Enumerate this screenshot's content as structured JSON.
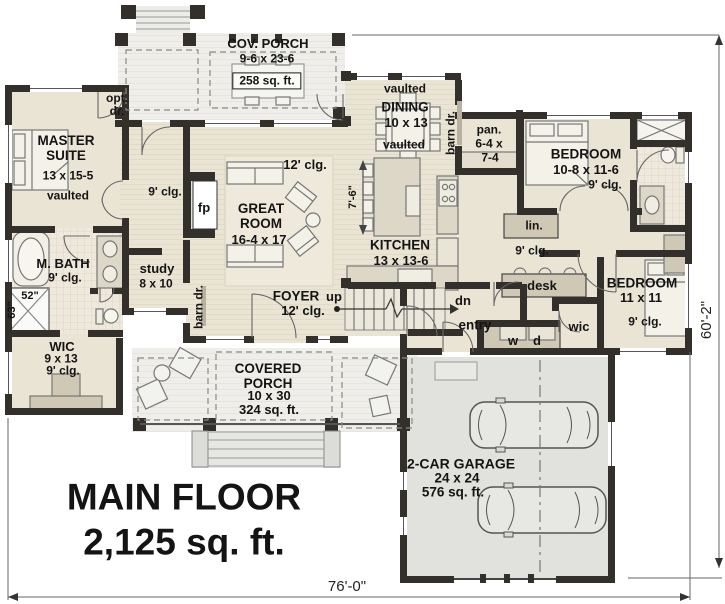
{
  "palette": {
    "wall": "#33302c",
    "floor_beige": "#e9e4d4",
    "porch_gray": "#efeeea",
    "garage_gray": "#e1e1de",
    "cabinet_taupe": "#cfc8b4",
    "text": "#141414"
  },
  "title": {
    "line1": "MAIN FLOOR",
    "line2": "2,125 sq. ft."
  },
  "dimensions": {
    "width": "76'-0\"",
    "height": "60'-2\""
  },
  "rooms": {
    "cov_porch": {
      "name": "COV. PORCH",
      "size": "9-6 x 23-6",
      "area": "258 sq. ft."
    },
    "master_suite": {
      "name": "MASTER SUITE",
      "size": "13 x 15-5",
      "ceiling": "vaulted"
    },
    "master_hall": {
      "ceiling": "9' clg."
    },
    "great_room": {
      "name": "GREAT ROOM",
      "size": "16-4 x 17",
      "ceiling": "12' clg."
    },
    "dining": {
      "name": "DINING",
      "size": "10 x 13",
      "vaulted_upper": "vaulted",
      "vaulted_lower": "vaulted"
    },
    "kitchen": {
      "name": "KITCHEN",
      "size": "13 x 13-6",
      "island_depth": "7'-6\""
    },
    "pantry": {
      "name": "pan.",
      "size_line1": "6-4 x",
      "size_line2": "7-4"
    },
    "study": {
      "name": "study",
      "size": "8 x 10"
    },
    "foyer": {
      "name": "FOYER",
      "ceiling": "12' clg.",
      "stairs": "up"
    },
    "master_bath": {
      "name": "M. BATH",
      "ceiling": "9' clg.",
      "shower_width": "52\"",
      "shower_depth": "63\""
    },
    "master_wic": {
      "name": "WIC",
      "size": "9 x 13",
      "ceiling": "9' clg."
    },
    "bedroom_2": {
      "name": "BEDROOM",
      "size": "10-8 x 11-6",
      "ceiling": "9' clg."
    },
    "bedroom_3": {
      "name": "BEDROOM",
      "size": "11 x 11",
      "ceiling": "9' clg."
    },
    "hall": {
      "ceiling": "9' clg."
    },
    "covered_porch": {
      "name": "COVERED PORCH",
      "size": "10 x 30",
      "area": "324 sq. ft."
    },
    "garage": {
      "name": "2-CAR GARAGE",
      "size": "24 x 24",
      "area": "576 sq. ft."
    }
  },
  "labels": {
    "opt_door": "opt. dr.",
    "fireplace": "fp",
    "barn_door_pantry": "barn dr.",
    "barn_door_study": "barn dr.",
    "linen": "lin.",
    "desk": "desk",
    "wic_small": "wic",
    "washer": "w",
    "dryer": "d",
    "entry": "entry",
    "stairs_down": "dn"
  }
}
